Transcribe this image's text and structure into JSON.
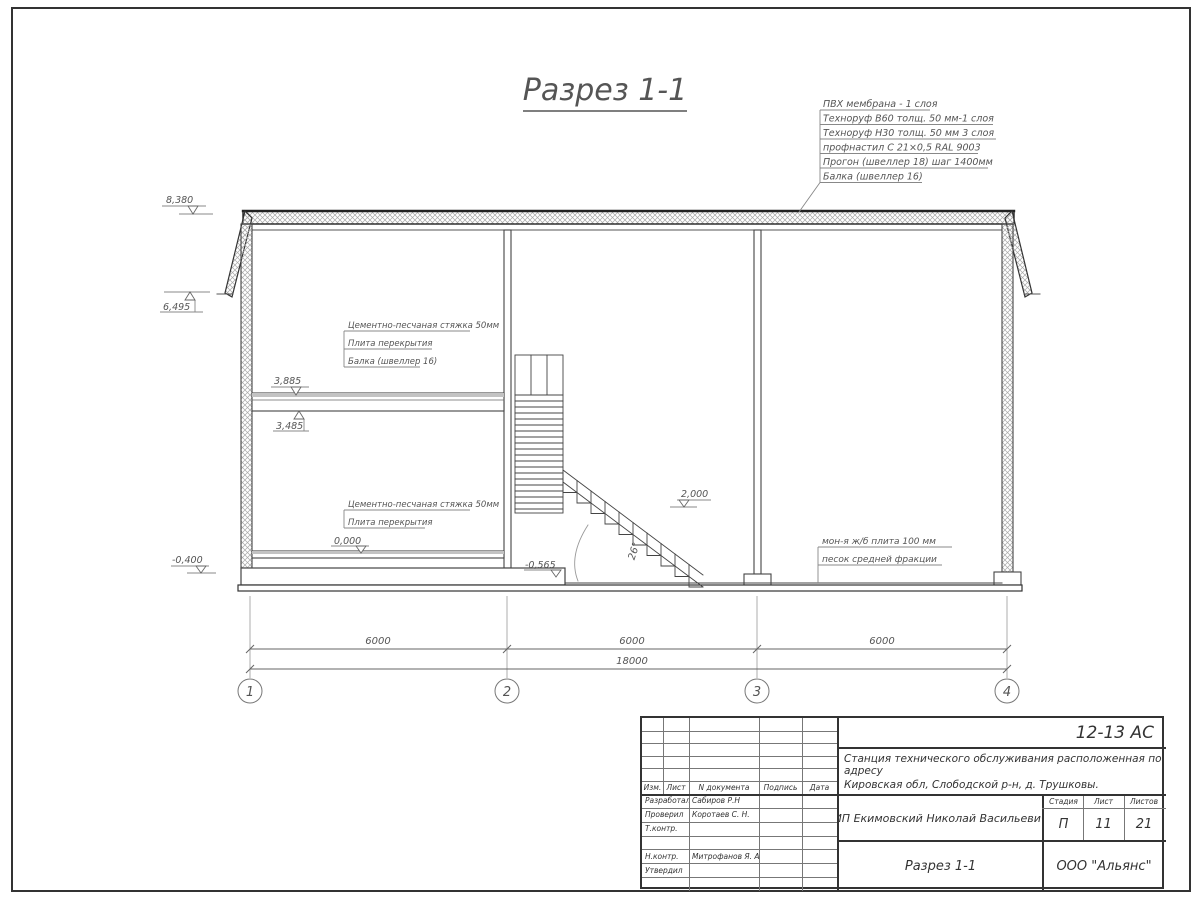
{
  "sheet_title": "Разрез 1-1",
  "roof_callout": [
    "ПВХ мембрана - 1 слоя",
    "Техноруф В60 толщ. 50 мм-1 слоя",
    "Техноруф Н30 толщ. 50 мм 3 слоя",
    "профнастил С 21×0,5 RAL 9003",
    "Прогон (швеллер 18) шаг 1400мм",
    "Балка (швеллер 16)"
  ],
  "floor2_callout": [
    "Цементно-песчаная стяжка 50мм",
    "Плита перекрытия",
    "Балка (швеллер 16)"
  ],
  "floor1_callout": [
    "Цементно-песчаная стяжка 50мм",
    "Плита перекрытия"
  ],
  "ground_callout": [
    "мон-я ж/б плита 100 мм",
    "песок средней фракции"
  ],
  "stair_angle": "26°",
  "elevations": {
    "roof": "8,380",
    "eaves": "6,495",
    "slab2_top": "3,885",
    "slab2_bot": "3,485",
    "floor0": "0,000",
    "grade": "-0,400",
    "landing": "2,000",
    "pit": "-0,565"
  },
  "dimensions": {
    "spans": [
      "6000",
      "6000",
      "6000"
    ],
    "total": "18000"
  },
  "axes": [
    "1",
    "2",
    "3",
    "4"
  ],
  "title_block": {
    "doc_code": "12-13 АС",
    "project_name_line1": "Станция технического обслуживания расположенная по адресу",
    "project_name_line2": "Кировская обл, Слободской р-н, д. Трушковы.",
    "columns": [
      "Изм.",
      "Лист",
      "N документа",
      "Подпись",
      "Дата"
    ],
    "signature_rows": [
      {
        "role": "Разработал",
        "name": "Сабиров Р.Н"
      },
      {
        "role": "Проверил",
        "name": "Коротаев С. Н."
      },
      {
        "role": "Т.контр.",
        "name": ""
      },
      {
        "role": "",
        "name": ""
      },
      {
        "role": "Н.контр.",
        "name": "Митрофанов Я. А."
      },
      {
        "role": "Утвердил",
        "name": ""
      },
      {
        "role": "",
        "name": ""
      }
    ],
    "client": "ИП Екимовский Николай Васильевич",
    "drawing_title": "Разрез 1-1",
    "stage_label": "Стадия",
    "sheet_label": "Лист",
    "sheets_label": "Листов",
    "stage": "П",
    "sheet_number": "11",
    "sheet_count": "21",
    "company": "ООО \"Альянс\""
  }
}
